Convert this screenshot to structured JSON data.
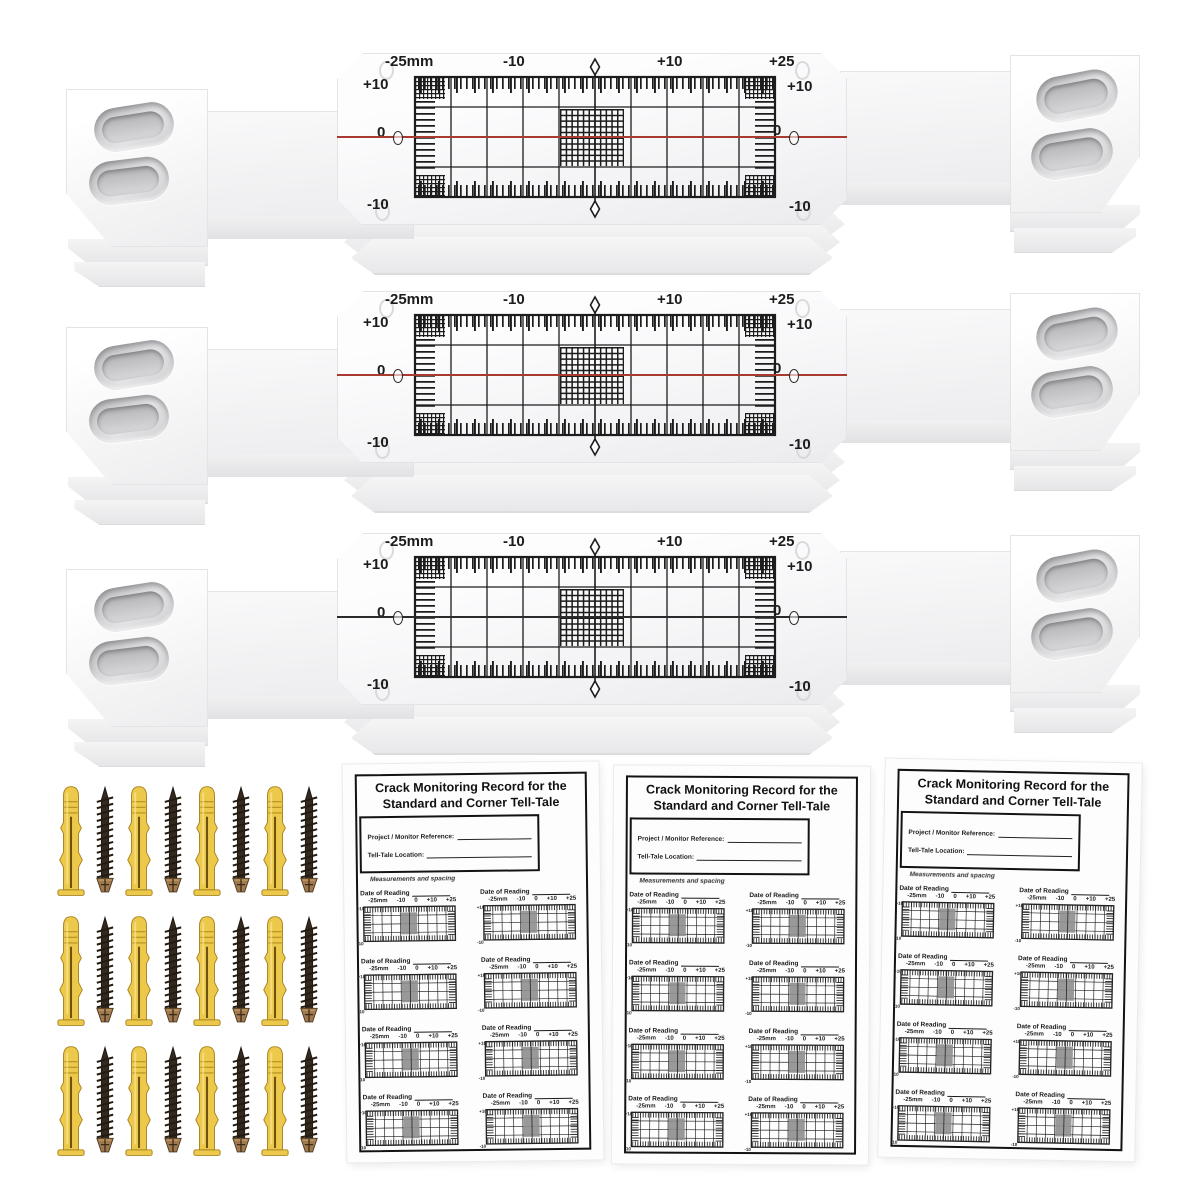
{
  "gauge": {
    "scale_top": [
      "-25mm",
      "-10",
      "+10",
      "+25"
    ],
    "scale_left": [
      "+10",
      "0",
      "-10"
    ],
    "scale_right": [
      "+10",
      "0",
      "-10"
    ],
    "ink_color": "#1c1c1c"
  },
  "gauges": [
    {
      "center_line_color": "#a93a30"
    },
    {
      "center_line_color": "#a93a30"
    },
    {
      "center_line_color": "#2b2b2b"
    }
  ],
  "record_sheet": {
    "title_line1": "Crack Monitoring Record for the",
    "title_line2": "Standard and Corner Tell-Tale",
    "project_field_label": "Project / Monitor Reference:",
    "location_field_label": "Tell-Tale Location:",
    "note": "Measurements and spacing",
    "entry_label": "Date of Reading",
    "entry_scale": [
      "-25mm",
      "-10",
      "0",
      "+10",
      "+25"
    ],
    "mini_scale_left_top": "+10",
    "mini_scale_left_bottom": "-10"
  },
  "hardware": {
    "plug_color": "#ecc94b",
    "plug_edge_color": "#a8821e",
    "screw_color": "#33291e",
    "screw_head_color": "#a07a4e"
  },
  "counts": {
    "gauges": 3,
    "record_sheets": 3,
    "entries_per_sheet": 8,
    "fixing_pairs": 12
  }
}
